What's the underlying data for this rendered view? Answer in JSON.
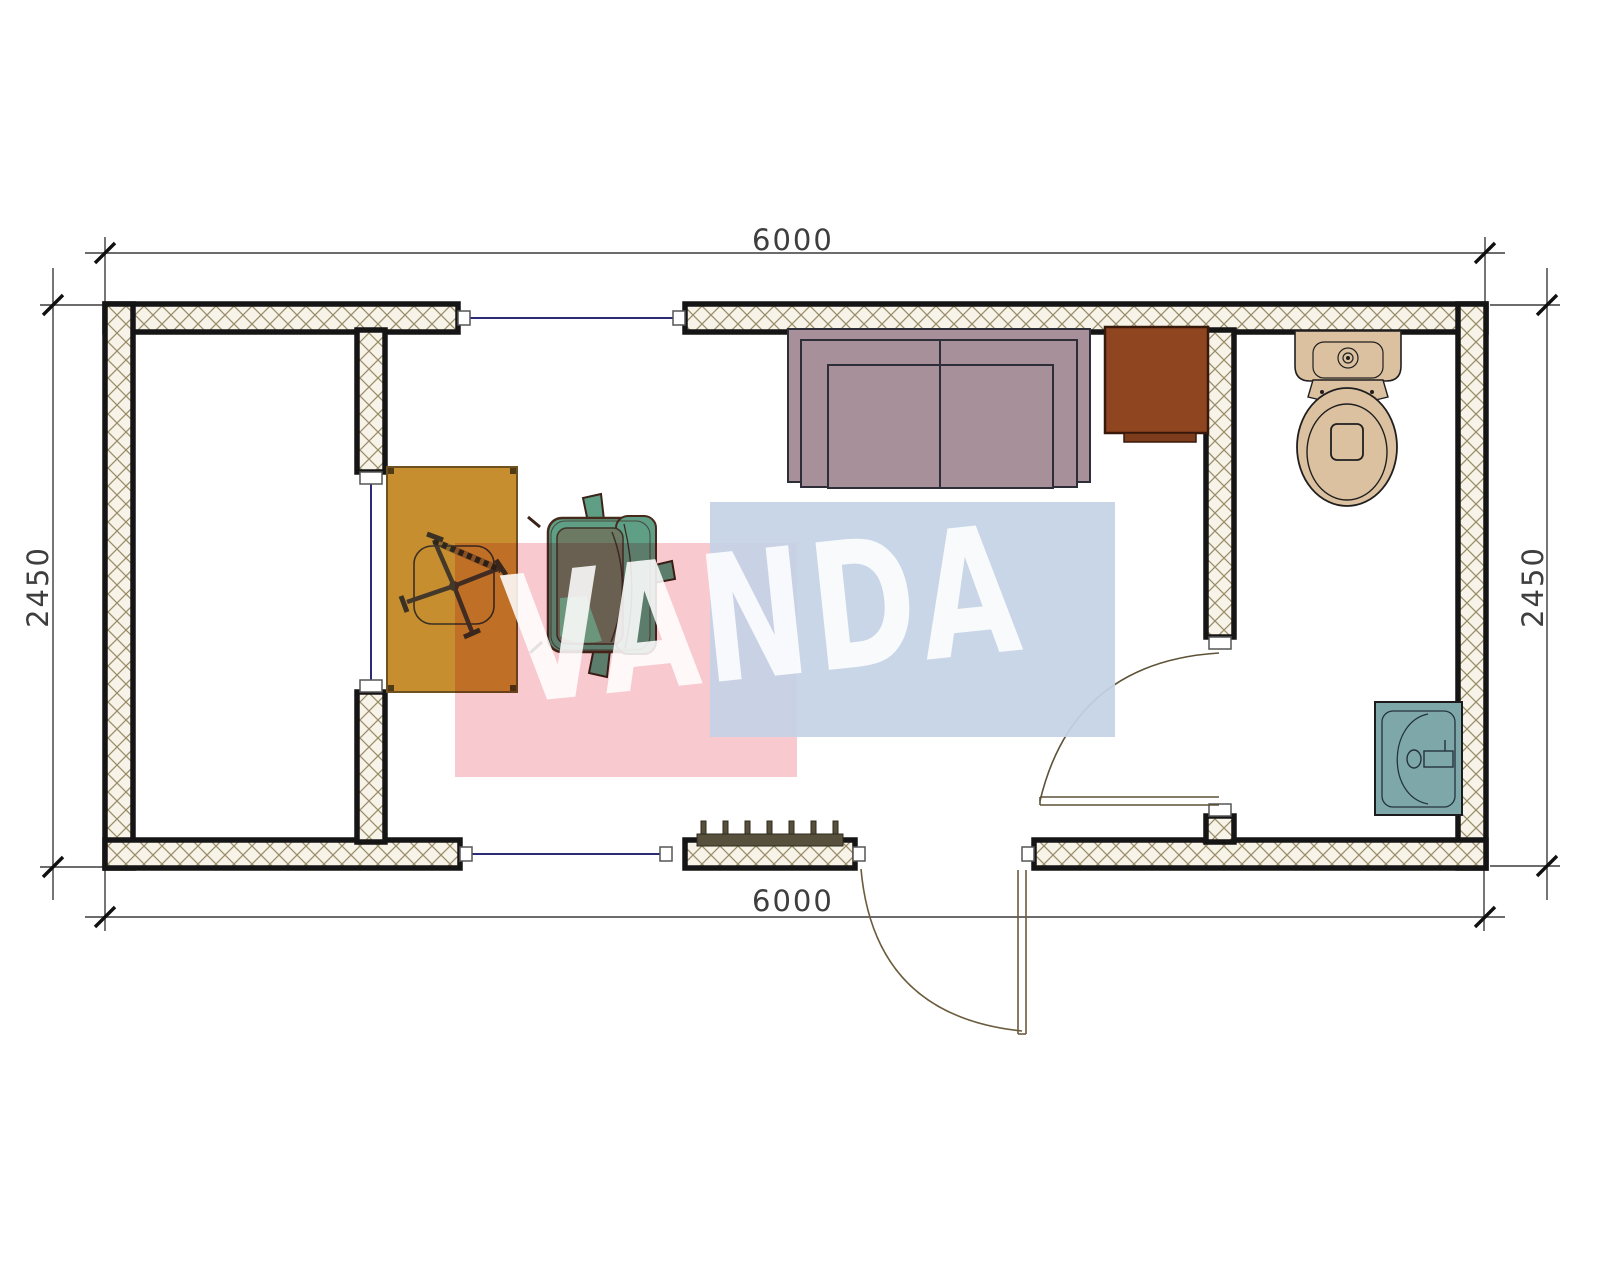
{
  "page": {
    "type": "architectural floor plan, top view",
    "background": "#ffffff"
  },
  "watermark": {
    "text": "VANDA",
    "pink_color": "#f8c9ce",
    "blue_color": "#c5d3e6",
    "letter_color": "#ffffff"
  },
  "dimensions": {
    "top": "6000",
    "bottom": "6000",
    "left": "2450",
    "right": "2450"
  },
  "walls": {
    "outline_color": "#151515",
    "hatch_line_color": "#9a8d6a",
    "hatch_fill_color": "#f7f3e8",
    "opening_line_color": "#2b2b78"
  },
  "doors": {
    "line_color": "#6b5c3e"
  },
  "furniture": {
    "desk": {
      "color": "#c68e2f"
    },
    "office_chair_base": {
      "color": "#44382a"
    },
    "armchair": {
      "color": "#5f9f85",
      "seat_color": "#6c7a64",
      "cushion_highlight": "#6fc7a0"
    },
    "sofa": {
      "color": "#a8909b"
    },
    "cabinet": {
      "color": "#8e4520"
    },
    "toilet": {
      "color": "#dcc1a1"
    },
    "sink": {
      "color": "#7ea7aa"
    },
    "entrance_grate": {
      "color": "#57503c"
    }
  }
}
